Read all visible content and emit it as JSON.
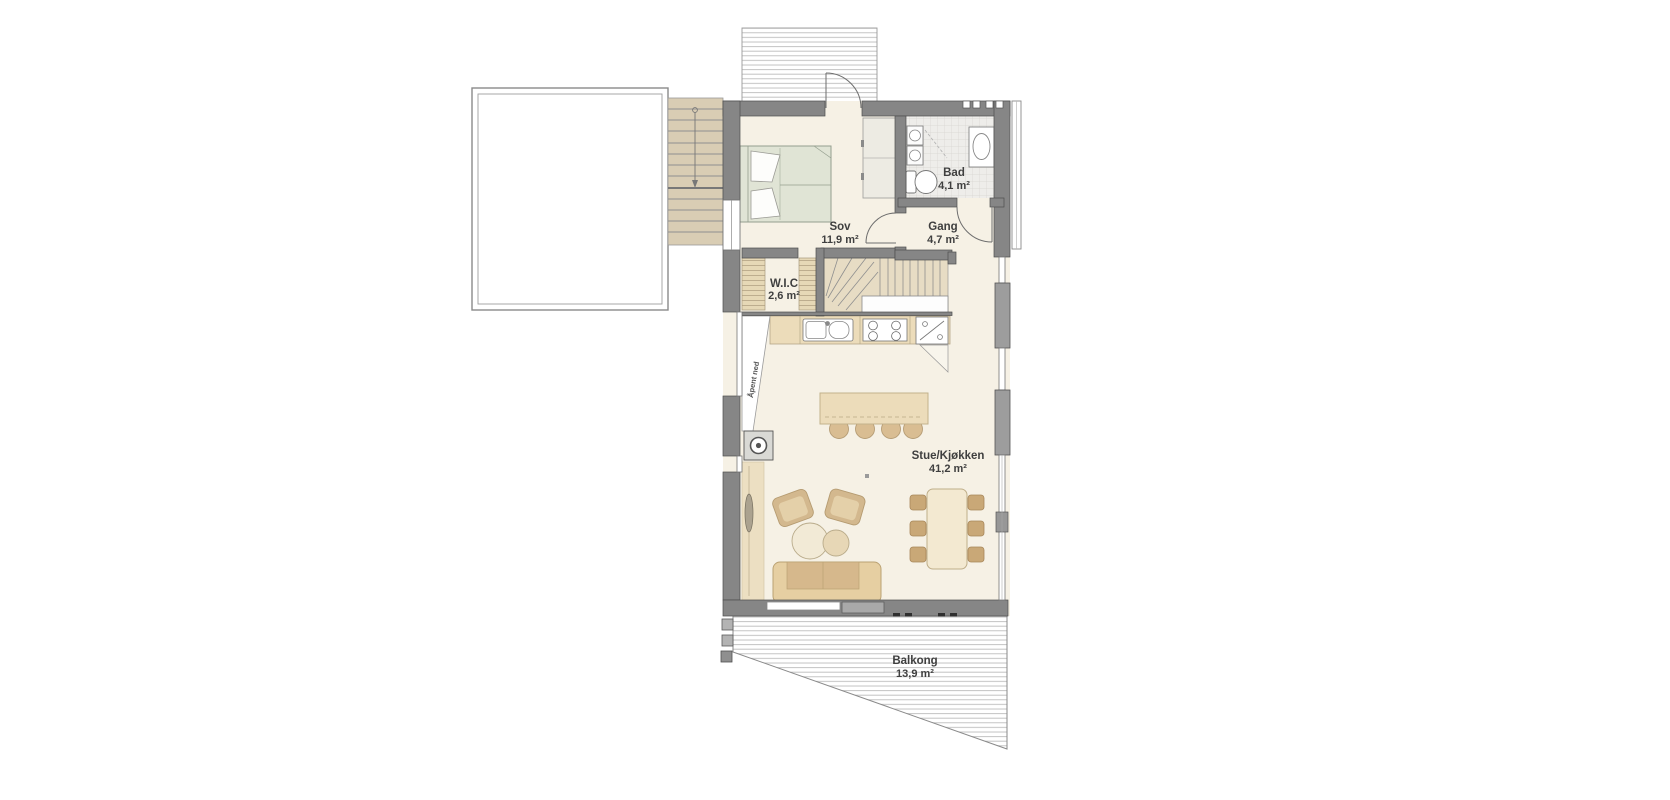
{
  "plan": {
    "rooms": {
      "sov": {
        "name": "Sov",
        "area": "11,9 m²"
      },
      "bad": {
        "name": "Bad",
        "area": "4,1 m²"
      },
      "gang": {
        "name": "Gang",
        "area": "4,7 m²"
      },
      "wic": {
        "name": "W.I.C",
        "area": "2,6 m²"
      },
      "stue": {
        "name": "Stue/Kjøkken",
        "area": "41,2 m²"
      },
      "balkong": {
        "name": "Balkong",
        "area": "13,9 m²"
      }
    },
    "annotations": {
      "open_below": "Åpent ned"
    },
    "colors": {
      "wall": "#868686",
      "window_block": "#9d9d9d",
      "floor": "#f6f1e5",
      "counter_wood": "#ecdcba",
      "stair_wood": "#d9cdb4",
      "sofa": "#e6cfa2",
      "bed": "#e0e4d5",
      "tile_floor": "#eeedea"
    }
  }
}
